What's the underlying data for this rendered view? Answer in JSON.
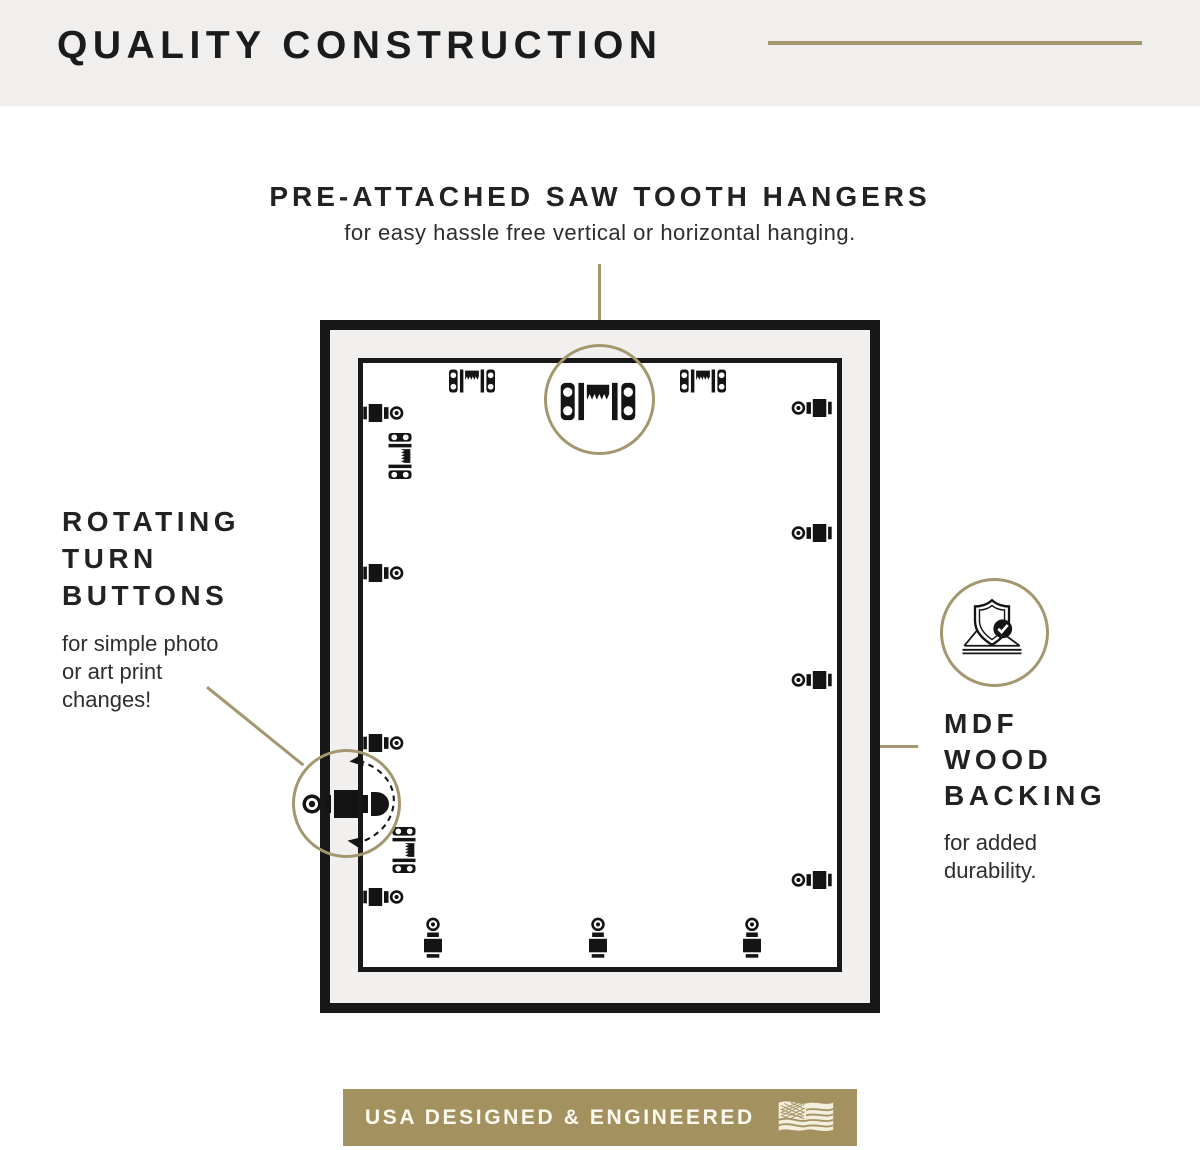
{
  "colors": {
    "accent_gold": "#a2976e",
    "banner_gold": "#a39260",
    "ink": "#181818",
    "header_bg": "#f1efee",
    "flag_cream": "#f3eedd"
  },
  "header": {
    "title": "QUALITY CONSTRUCTION"
  },
  "callout_hangers": {
    "title": "PRE-ATTACHED SAW TOOTH HANGERS",
    "subtitle": "for easy hassle free vertical or horizontal hanging."
  },
  "callout_turn_buttons": {
    "title_lines": [
      "ROTATING",
      "TURN",
      "BUTTONS"
    ],
    "subtitle": "for simple photo or art print changes!"
  },
  "callout_backing": {
    "title_lines": [
      "MDF",
      "WOOD",
      "BACKING"
    ],
    "subtitle": "for added durability."
  },
  "banner": {
    "label": "USA DESIGNED & ENGINEERED"
  },
  "icons": {
    "sawtooth_hanger": "sawtooth-hanger-icon",
    "turn_button": "turn-button-icon",
    "rotating_turn_button": "rotating-turn-button-icon",
    "shield_check": "shield-check-icon",
    "usa_flag": "usa-flag-icon",
    "rotation_arrows": "rotation-arrows-icon"
  }
}
